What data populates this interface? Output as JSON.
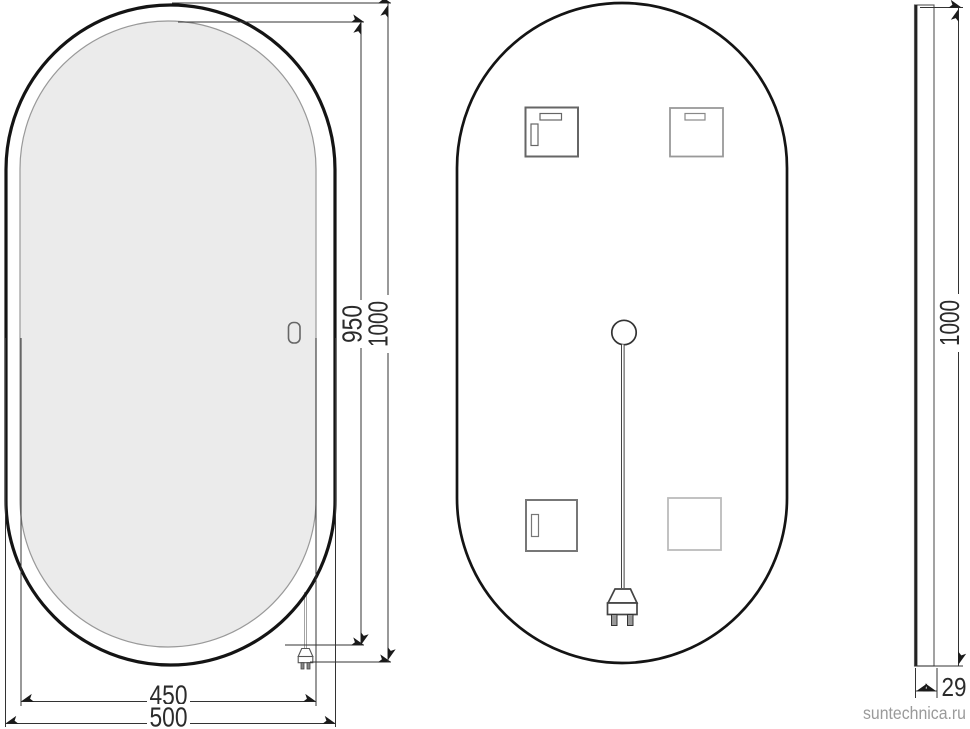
{
  "watermark": "suntechnica.ru",
  "front_view": {
    "inner_height": "950",
    "total_height": "1000",
    "inner_width": "450",
    "total_width": "500"
  },
  "side_view": {
    "height": "1000",
    "thickness": "29"
  }
}
